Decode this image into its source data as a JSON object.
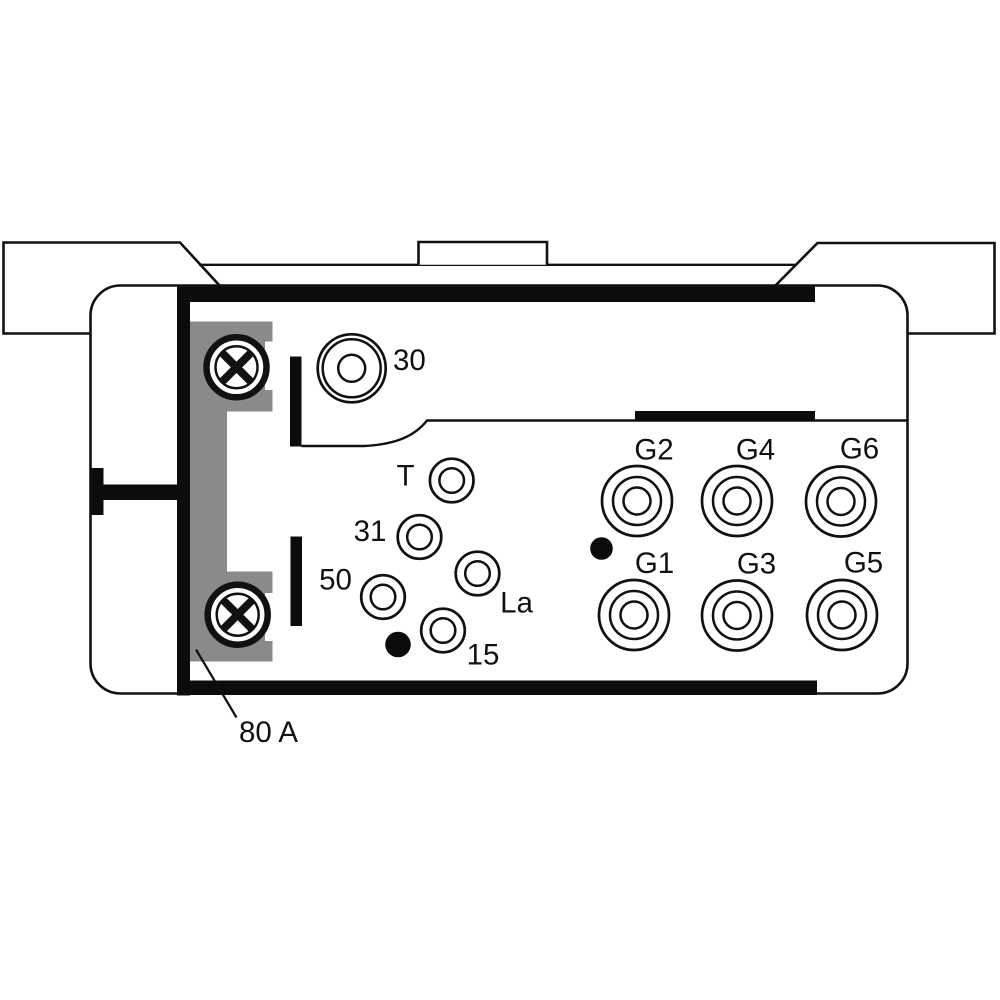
{
  "diagram": {
    "kind": "relay-connector-pinout",
    "colors": {
      "line": "#111111",
      "background": "#ffffff",
      "fuse_shade": "#8a8a8a"
    },
    "labels": {
      "terminal_30": "30",
      "terminal_T": "T",
      "terminal_31": "31",
      "terminal_50": "50",
      "terminal_La": "La",
      "terminal_15": "15",
      "glow_G1": "G1",
      "glow_G2": "G2",
      "glow_G3": "G3",
      "glow_G4": "G4",
      "glow_G5": "G5",
      "glow_G6": "G6",
      "fuse_rating": "80 A"
    },
    "terminals": {
      "large": [
        "30"
      ],
      "small": [
        "T",
        "31",
        "50",
        "La",
        "15"
      ],
      "glow_outputs_top_row": [
        "G2",
        "G4",
        "G6"
      ],
      "glow_outputs_bottom_row": [
        "G1",
        "G3",
        "G5"
      ],
      "fuse": "80 A"
    }
  }
}
